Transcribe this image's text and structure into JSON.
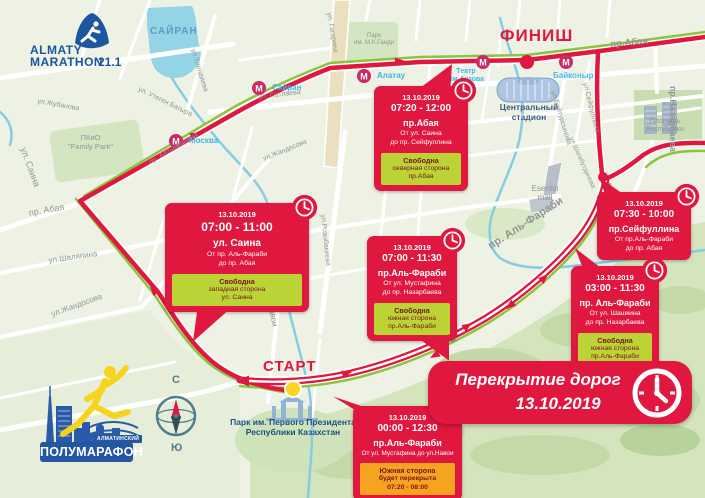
{
  "branding": {
    "top_logo": {
      "line1": "ALMATY",
      "line2": "MARATHON",
      "distance": "21.1"
    },
    "bottom_logo": {
      "tag": "АЛМАТИНСКИЙ",
      "title": "ПОЛУМАРАФОН"
    }
  },
  "banner": {
    "line1": "Перекрытие дорог",
    "line2": "13.10.2019"
  },
  "markers": {
    "start": "СТАРТ",
    "finish": "ФИНИШ"
  },
  "compass": {
    "north": "С",
    "south": "Ю"
  },
  "metro": {
    "letter": "М",
    "stations": {
      "sairan": "Сайран",
      "moskva": "Москва",
      "alatau": "Алатау",
      "baikonur": "Байконыр"
    }
  },
  "callouts": [
    {
      "date": "13.10.2019",
      "time": "07:00 - 11:00",
      "street": "ул. Саина",
      "range": "От пр. Аль-Фараби\nдо пр. Абая",
      "note_title": "Свободна",
      "note_body": "западная сторона\nул. Саина"
    },
    {
      "date": "13.10.2019",
      "time": "07:20 - 12:00",
      "street": "пр.Абая",
      "range": "От ул. Саина\nдо пр. Сейфуллина",
      "note_title": "Свободна",
      "note_body": "северная сторона\nпр.Абая"
    },
    {
      "date": "13.10.2019",
      "time": "07:00 - 11:30",
      "street": "пр.Аль-Фараби",
      "range": "От ул. Мустафина\nдо пр. Назарбаева",
      "note_title": "Свободна",
      "note_body": "южная сторона\nпр.Аль-Фараби"
    },
    {
      "date": "13.10.2019",
      "time": "07:30 - 10:00",
      "street": "пр.Сейфуллина",
      "range": "От пр.Аль-Фараби\nдо пр. Абая"
    },
    {
      "date": "13.10.2019",
      "time": "03:00 - 11:30",
      "street": "пр. Аль-Фараби",
      "range": "От ул. Шашкина\nдо пр. Назарбаева",
      "note_title": "Свободна",
      "note_body": "южная сторона\nпр.Аль-Фараби"
    },
    {
      "date": "13.10.2019",
      "time": "00:00 - 12:30",
      "street": "пр.Аль-Фараби",
      "range": "От ул. Мустафина до ул.Навои",
      "note_title": "Южная сторона",
      "note_body": "будет перекрыта\n07:20 - 08:00"
    }
  ],
  "map": {
    "labels": [
      {
        "text": "САЙРАН"
      },
      {
        "text": "ул.Тлендиева"
      },
      {
        "text": "ул. Утеген Батыра"
      },
      {
        "text": "ул.Жубанова"
      },
      {
        "text": "ул. Саина"
      },
      {
        "text": "ПКиО\n\"Family Park\""
      },
      {
        "text": "пр. Абая"
      },
      {
        "text": "ул.Шаляпина"
      },
      {
        "text": "ул.Жандосова"
      },
      {
        "text": "ул. Сатпаева"
      },
      {
        "text": "пр. Алтынсарина"
      },
      {
        "text": "ул. Гагарина"
      },
      {
        "text": "Парк\nим. М.К.Ганди"
      },
      {
        "text": "ул.Жандосова"
      },
      {
        "text": "ул.Розыбакиева"
      },
      {
        "text": "ул. Навои"
      },
      {
        "text": "пр. Аль-Фараби"
      },
      {
        "text": "Esentai\nmall"
      },
      {
        "text": "Центральный\nстадион"
      },
      {
        "text": "Театр\nим.Аузова"
      },
      {
        "text": "Площадь\nРеспублики"
      },
      {
        "text": "пр.Назарбаева"
      },
      {
        "text": "ул.Сейфуллина"
      },
      {
        "text": "ул.Байтурсынова"
      },
      {
        "text": "ул.Шагабутдинова"
      },
      {
        "text": "Парк им. Первого Президента\nРеспублики Казахстан"
      },
      {
        "text": "пр.Абая"
      }
    ]
  },
  "colors": {
    "accent_red": "#e0173f",
    "route_green": "#8bc53f",
    "note_green": "#bbd334",
    "note_orange": "#f6a41f",
    "metro_pink": "#cb2a62",
    "brand_blue": "#1c56a0",
    "water_blue": "#93d4e6"
  }
}
